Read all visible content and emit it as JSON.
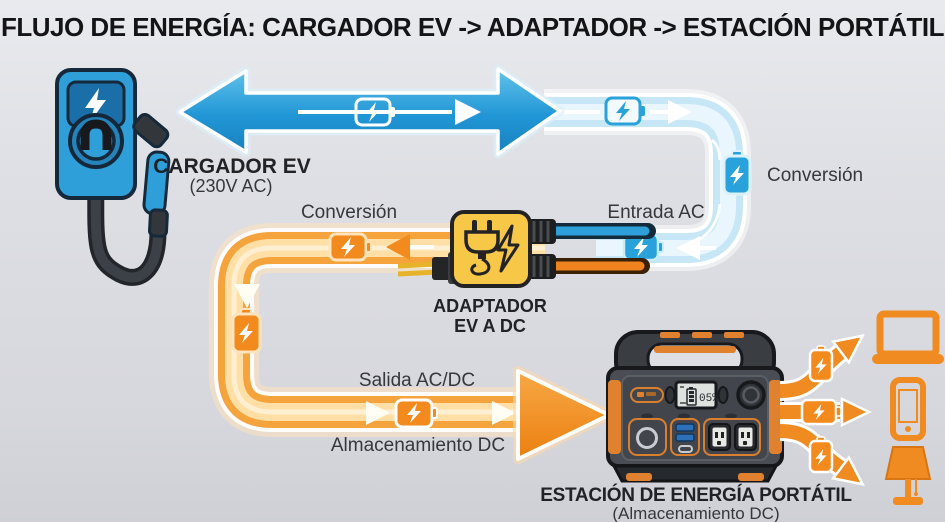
{
  "title": "FLUJO DE ENERGÍA: CARGADOR EV -> ADAPTADOR -> ESTACIÓN PORTÁTIL",
  "nodes": {
    "charger": {
      "label": "CARGADOR EV",
      "sublabel": "(230V AC)"
    },
    "adapter": {
      "label": "ADAPTADOR",
      "sublabel": "EV A DC"
    },
    "station": {
      "label": "ESTACIÓN DE ENERGÍA PORTÁTIL",
      "sublabel": "(Almacenamiento DC)",
      "display": "05%"
    }
  },
  "flow_labels": {
    "ac_conversion": "Conversión",
    "ac_input": "Entrada AC",
    "dc_conversion": "Conversión",
    "dc_output": "Salida AC/DC",
    "dc_storage": "Almacenamiento DC"
  },
  "icons": {
    "battery_charging": "battery-charging-icon",
    "lightning_bolt": "lightning-bolt-icon",
    "plug": "plug-icon",
    "ev_charger": "ev-charger-icon",
    "power_station": "power-station-icon",
    "laptop": "laptop-icon",
    "smartphone": "smartphone-icon",
    "lamp": "lamp-icon"
  },
  "colors": {
    "ac_blue": "#2196d6",
    "ac_blue_light": "#c7e7f7",
    "dc_orange": "#f08a1d",
    "dc_orange_light": "#ffdfa6",
    "adapter_yellow": "#f7c847",
    "station_gray": "#4a4e54",
    "accent_orange": "#e0812f",
    "background": "#dedfe4",
    "text": "#37373b"
  }
}
